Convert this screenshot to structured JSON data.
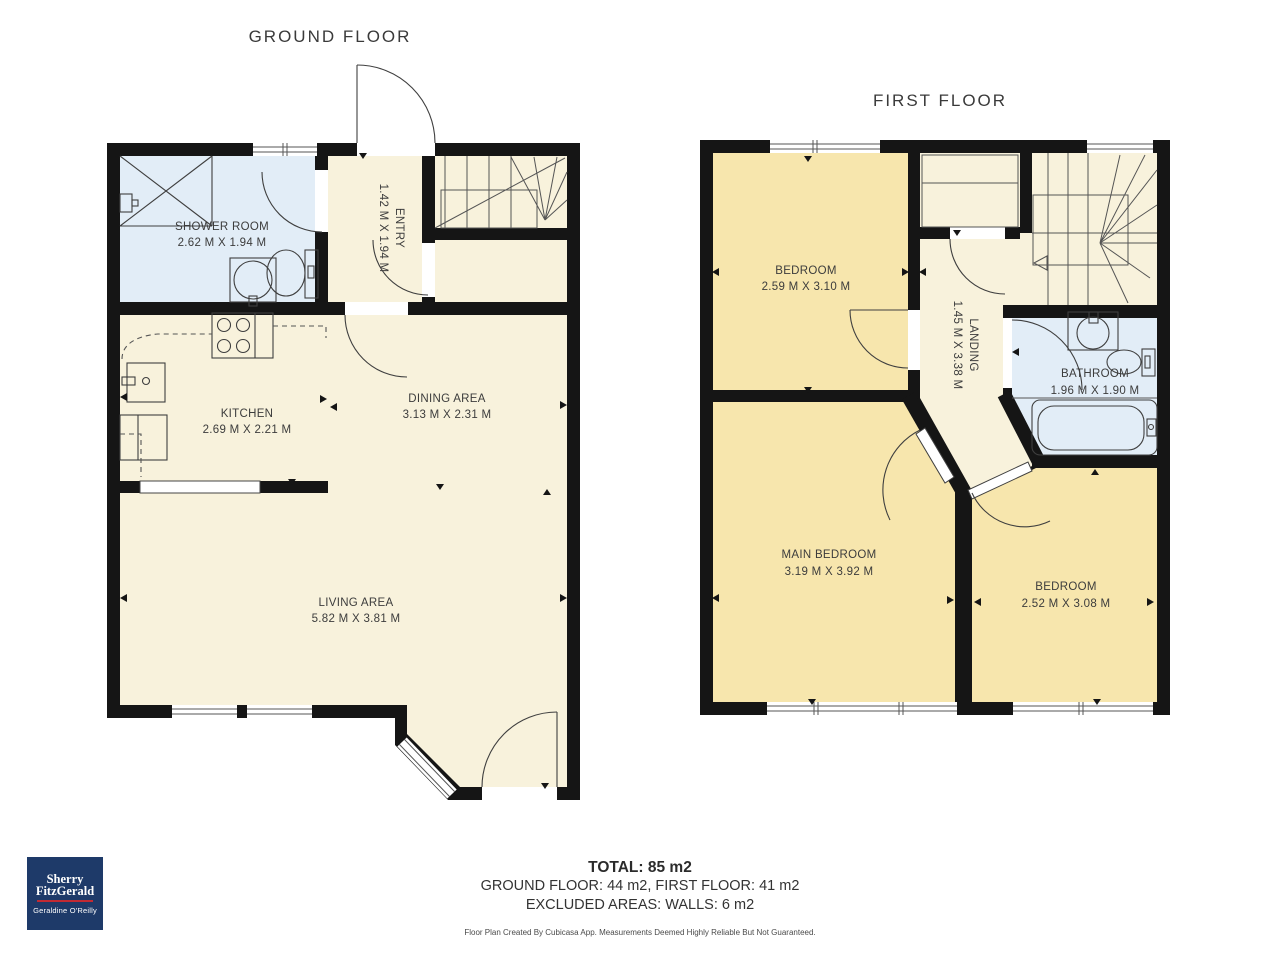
{
  "colors": {
    "wall": "#151515",
    "floor_cream": "#f8f2dc",
    "floor_yellow": "#f7e6ad",
    "floor_blue": "#e2edf7",
    "line": "#3f3f3f",
    "text": "#3c3c3c",
    "logo_navy": "#1e3a69",
    "logo_red": "#c22a33"
  },
  "ground_floor": {
    "title": "GROUND FLOOR",
    "rooms": [
      {
        "name": "SHOWER ROOM",
        "dims": "2.62 M X 1.94 M"
      },
      {
        "name": "ENTRY",
        "dims": "1.42 M X 1.94 M"
      },
      {
        "name": "KITCHEN",
        "dims": "2.69 M X 2.21 M"
      },
      {
        "name": "DINING AREA",
        "dims": "3.13 M X 2.31 M"
      },
      {
        "name": "LIVING AREA",
        "dims": "5.82 M X 3.81 M"
      }
    ]
  },
  "first_floor": {
    "title": "FIRST FLOOR",
    "rooms": [
      {
        "name": "BEDROOM",
        "dims": "2.59 M X 3.10 M"
      },
      {
        "name": "LANDING",
        "dims": "1.45 M X 3.38 M"
      },
      {
        "name": "BATHROOM",
        "dims": "1.96 M X 1.90 M"
      },
      {
        "name": "MAIN BEDROOM",
        "dims": "3.19 M X 3.92 M"
      },
      {
        "name": "BEDROOM",
        "dims": "2.52 M X 3.08 M"
      }
    ]
  },
  "summary": {
    "total": "TOTAL: 85 m2",
    "floors": "GROUND FLOOR: 44 m2, FIRST FLOOR: 41 m2",
    "excluded": "EXCLUDED AREAS: WALLS: 6 m2",
    "disclaimer": "Floor Plan Created By Cubicasa App. Measurements Deemed Highly Reliable But Not Guaranteed."
  },
  "logo": {
    "brand_line1": "Sherry",
    "brand_line2": "FitzGerald",
    "agent": "Geraldine O'Reilly"
  }
}
